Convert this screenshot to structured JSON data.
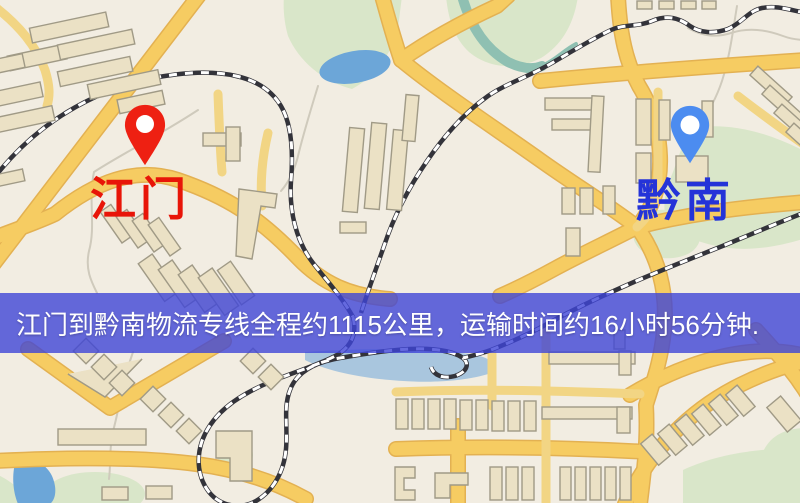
{
  "markers": {
    "origin": {
      "name": "江门",
      "label_color": "#e81508",
      "pin_color": "#ee2012",
      "pin_icon": "map-pin-icon"
    },
    "destination": {
      "name": "黔南",
      "label_color": "#2433d8",
      "pin_color": "#4c8cf0",
      "pin_icon": "map-pin-icon"
    }
  },
  "banner": {
    "text": "江门到黔南物流专线全程约1115公里，运输时间约16小时56分钟.",
    "background_color": "#3f45d7",
    "text_color": "#ffffff"
  },
  "route": {
    "origin_city": "江门",
    "destination_city": "黔南",
    "distance_km": "1115",
    "duration_hours": "16",
    "duration_minutes": "56"
  },
  "map_palette": {
    "land": "#f2ede2",
    "road_fill": "#f6cc62",
    "road_casing": "#e3b152",
    "road_minor": "#f2d584",
    "building_fill": "#ebe1c5",
    "building_stroke": "#a09a86",
    "green_area": "#d9e6c9",
    "water": "#6ca6d8",
    "water_light": "#a9c6de",
    "stream_teal": "#8fc0b2",
    "railway_dark": "#33333a",
    "railway_light": "#ffffff"
  }
}
